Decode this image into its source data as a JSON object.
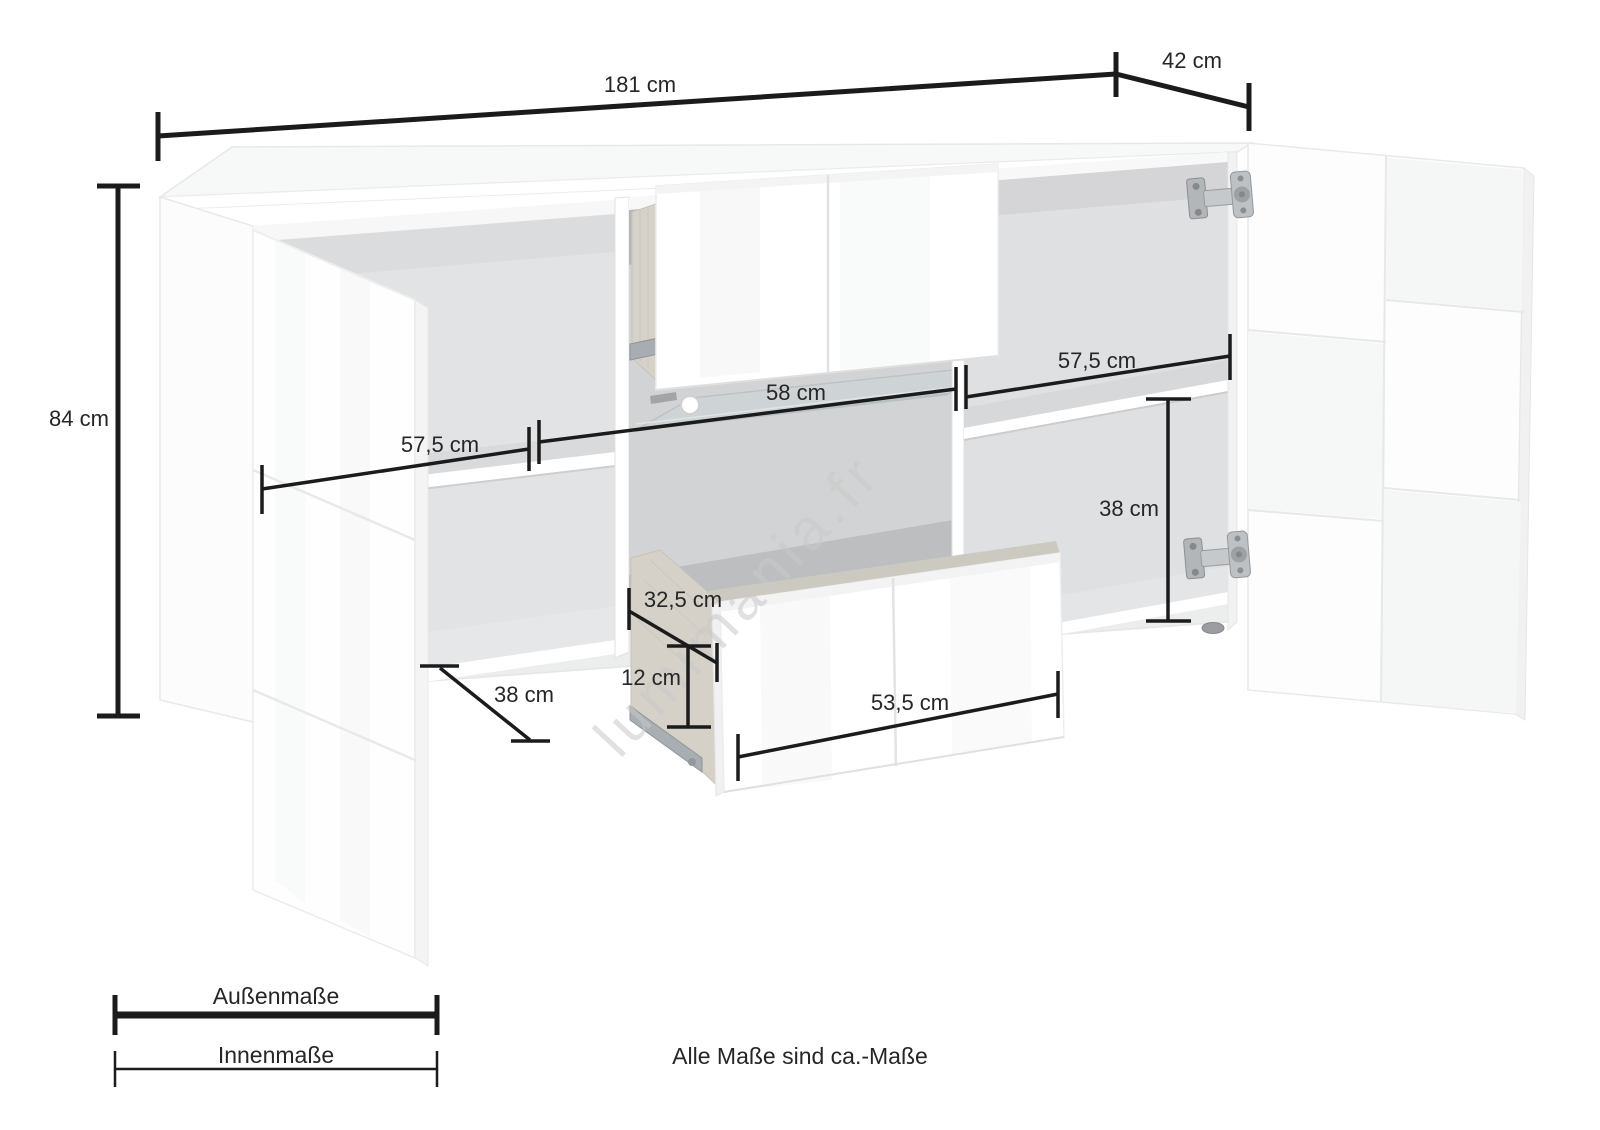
{
  "diagram": {
    "labels": {
      "width_total": "181 cm",
      "depth_total": "42 cm",
      "height_total": "84 cm",
      "inner_left_width": "57,5 cm",
      "inner_middle_width": "58 cm",
      "inner_right_width": "57,5 cm",
      "inner_right_height": "38 cm",
      "drawer_inner_depth": "32,5 cm",
      "drawer_inner_height": "12 cm",
      "inner_left_depth": "38 cm",
      "drawer_inner_width": "53,5 cm"
    },
    "legend": {
      "outer": "Außenmaße",
      "inner": "Innenmaße"
    },
    "note": "Alle Maße sind ca.-Maße",
    "watermark": "lumimania.fr",
    "colors": {
      "line": "#1b1b1b",
      "text": "#262626",
      "watermark": "#c9c9c9"
    }
  }
}
